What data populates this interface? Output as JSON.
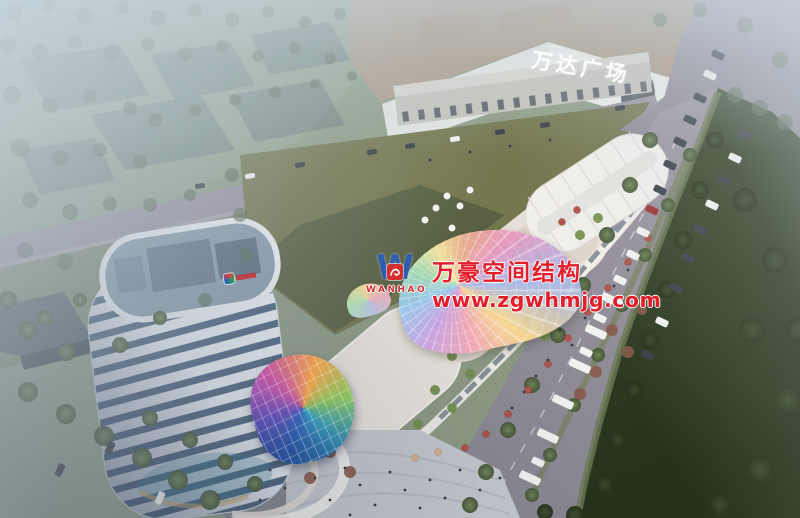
{
  "scene": {
    "description": "Aerial dusk rendering of a mixed-use commercial plaza: curved white tower, retail strip with iridescent canopies, Wanda Plaza mall, avenue and green fields"
  },
  "signs": {
    "wanda_plaza": "万达广场"
  },
  "watermark": {
    "company": "万豪空间结构",
    "website": "www.zgwhmjg.com",
    "logo_monogram": "W",
    "logo_text": "WANHAO",
    "text_color": "#e51e2b",
    "logo_blue": "#2e5fae",
    "logo_red": "#d32f2f"
  },
  "palette": {
    "haze": "#c6d4de",
    "field_olive": "#75774f",
    "field_dark_green": "#2f3e26",
    "road": "#968f9a",
    "tower_white": "#eef2f6",
    "tower_glass": "#4d6680",
    "accent_red": "#b5424e",
    "dome_blue": "#3b6fc4",
    "canopy_gold": "#f8d890"
  }
}
